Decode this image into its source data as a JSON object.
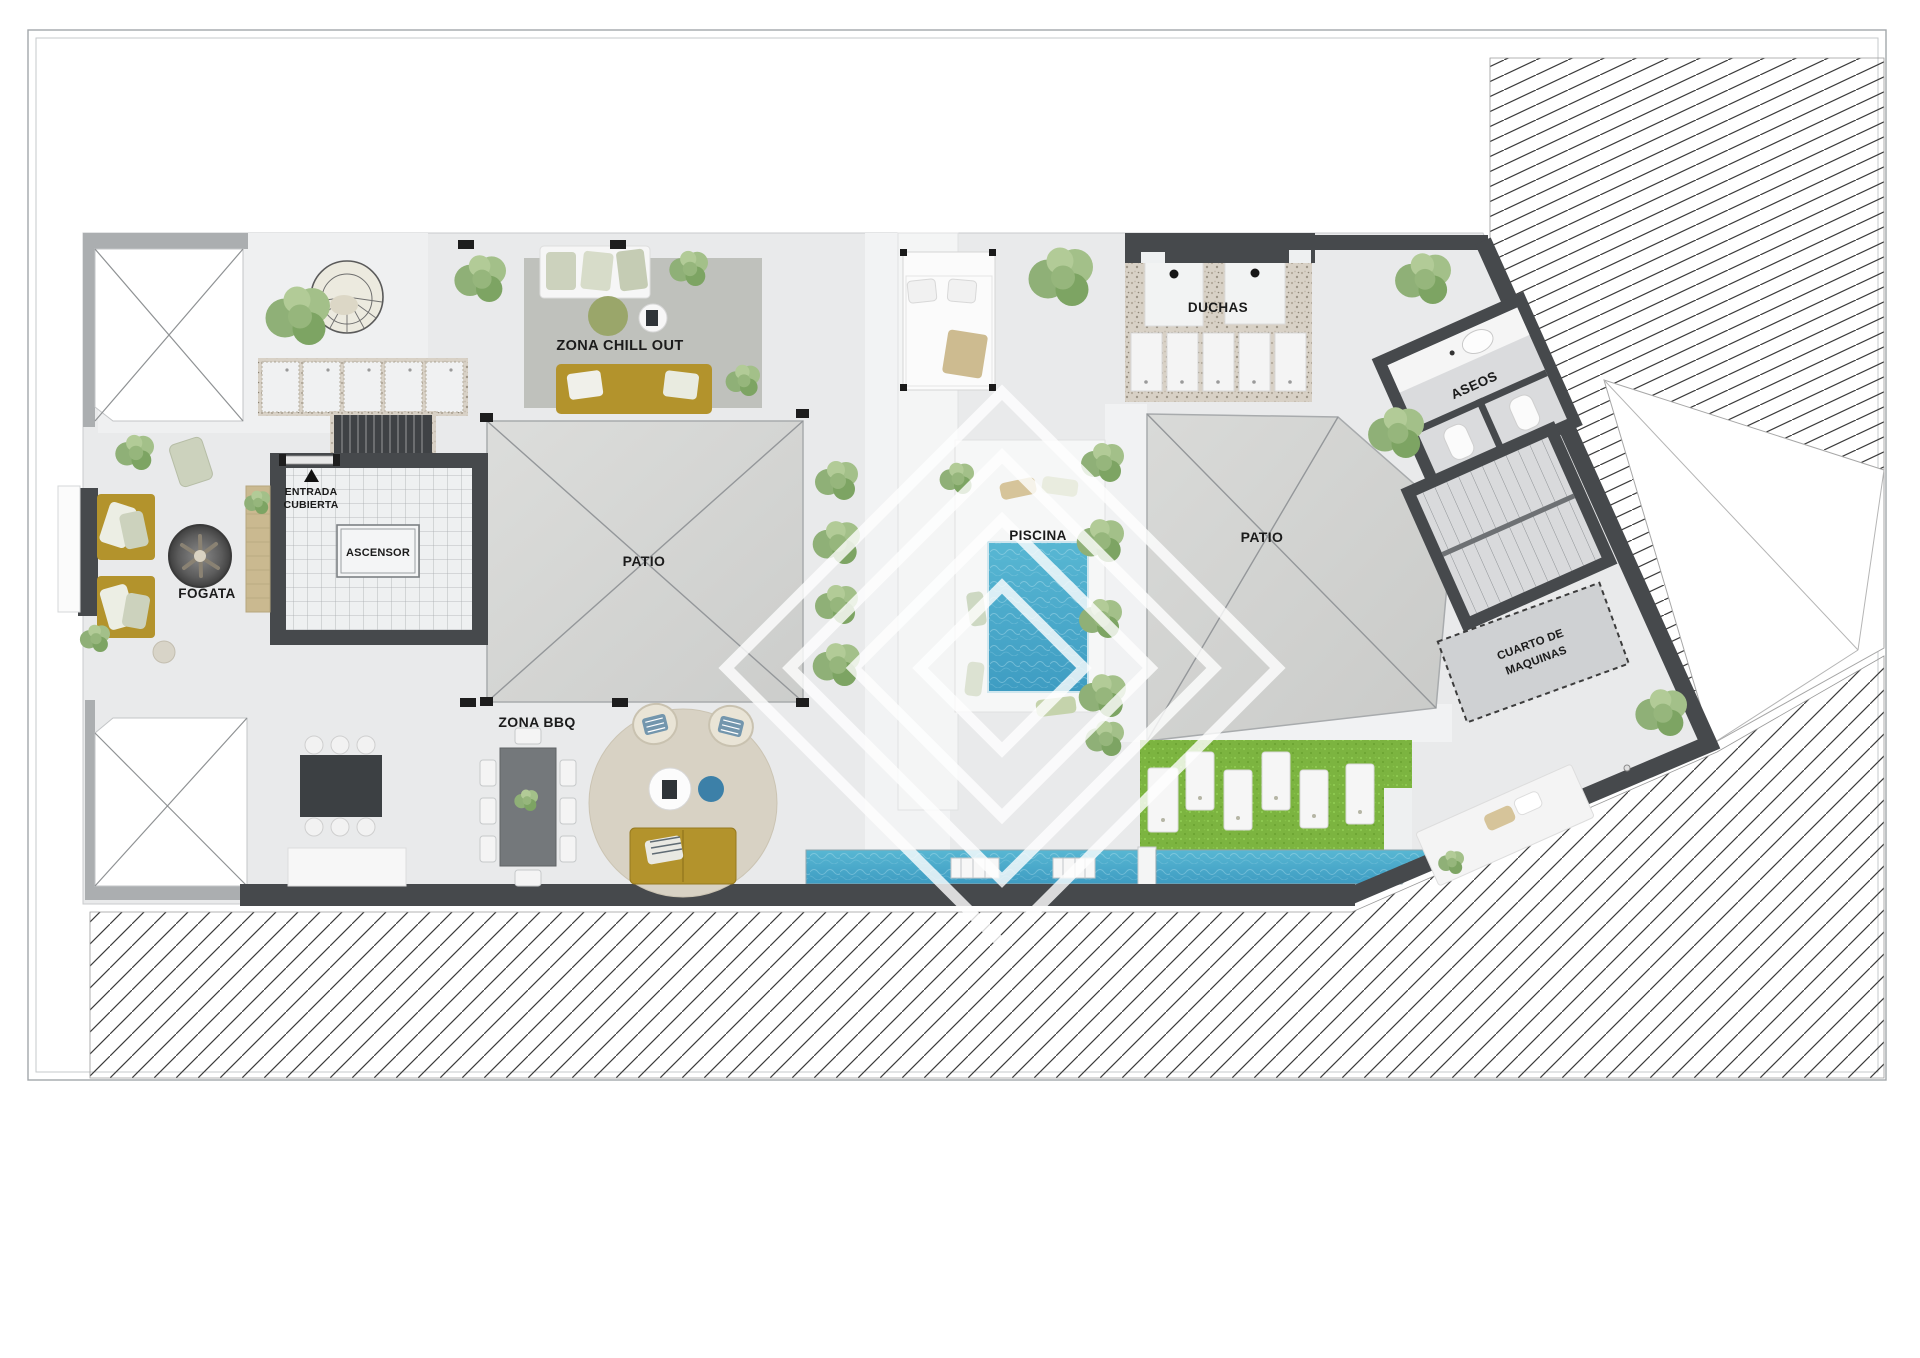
{
  "plan": {
    "labels": {
      "zona_chill_out": "ZONA CHILL OUT",
      "duchas": "DUCHAS",
      "aseos": "ASEOS",
      "entrada_line1": "ENTRADA",
      "entrada_line2": "CUBIERTA",
      "ascensor": "ASCENSOR",
      "patio_left": "PATIO",
      "piscina": "PISCINA",
      "patio_right": "PATIO",
      "fogata": "FOGATA",
      "zona_bbq": "ZONA BBQ",
      "cuarto_maquinas_line1": "CUARTO DE",
      "cuarto_maquinas_line2": "MAQUINAS"
    },
    "colors": {
      "wall": "#46494c",
      "deck": "#e9eaeb",
      "walkway": "#f2f3f4",
      "skylight": "#d6d7d5",
      "pool_water": "#4aadcd",
      "channel_water": "#3f9ec6",
      "lawn": "#7cb440",
      "gravel": "#d8d1c6",
      "mustard_sofa": "#b3932c",
      "olive_green": "#9aa66a",
      "rug_gray": "#bfc1bc",
      "rug_round": "#d8d2c4",
      "wood": "#cab990",
      "accent_blue": "#3c80a8",
      "hatch_line": "#3b3b3b",
      "label_text": "#1b1b1b",
      "frame_line": "#a3a7aa",
      "watermark": "#ffffff"
    },
    "watermark": {
      "shape": "nested-diamonds",
      "rings": 4
    }
  }
}
